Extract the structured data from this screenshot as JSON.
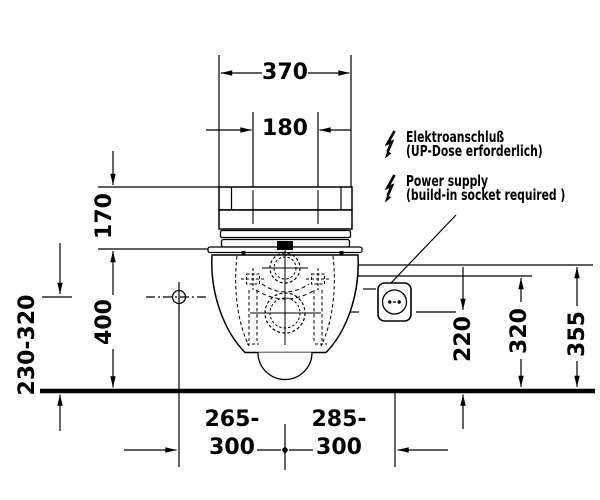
{
  "drawing_title": "wall-hung-toilet-rear-view-installation-dimensions",
  "dimensions": {
    "width_overall": "370",
    "width_seat_fixing": "180",
    "height_seat_unit": "170",
    "height_rim": "400",
    "height_fixing_range": "230-320",
    "height_socket_low": "220",
    "height_socket_mid": "320",
    "height_socket_high": "355",
    "offset_left_line1": "265-",
    "offset_left_line2": "300",
    "offset_right_line1": "285-",
    "offset_right_line2": "300"
  },
  "annotations": {
    "electrical_de_line1": "Elektroanschluß",
    "electrical_de_line2": "(UP-Dose erforderlich)",
    "electrical_en_line1": "Power supply",
    "electrical_en_line2": "(build-in socket required )"
  },
  "icons": {
    "lightning": "lightning-bolt-icon",
    "socket": "schuko-socket-icon"
  },
  "colors": {
    "line": "#000000",
    "background": "#ffffff"
  }
}
